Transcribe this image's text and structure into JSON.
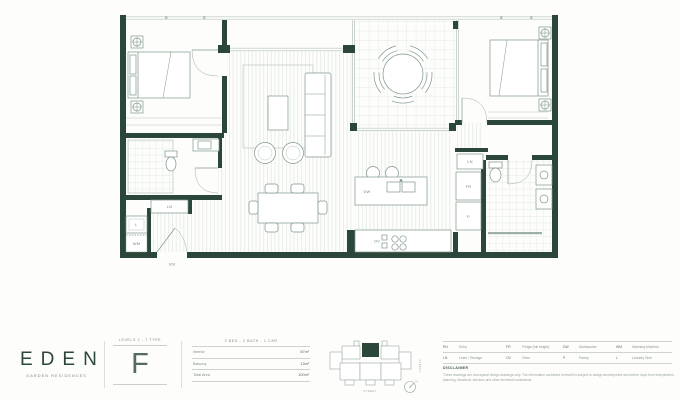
{
  "brand": {
    "name": "EDEN",
    "tagline": "GARDEN RESIDENCES"
  },
  "unit": {
    "levels_label": "LEVELS 2 - 7 TYPE",
    "type": "F",
    "config": "2 BED - 2 BATH - 1 CAR",
    "areas": [
      {
        "label": "Interior",
        "value": "87m²"
      },
      {
        "label": "Balcony",
        "value": "13m²"
      },
      {
        "label": "Total Area",
        "value": "100m²"
      }
    ]
  },
  "legend": {
    "rows": [
      [
        {
          "abbr": "EN",
          "label": "Entry"
        },
        {
          "abbr": "FR",
          "label": "Fridge (full height)"
        },
        {
          "abbr": "DW",
          "label": "Dishwasher"
        },
        {
          "abbr": "WM",
          "label": "Washing Machine"
        }
      ],
      [
        {
          "abbr": "LN",
          "label": "Linen / Storage"
        },
        {
          "abbr": "OV",
          "label": "Oven"
        },
        {
          "abbr": "P",
          "label": "Pantry"
        },
        {
          "abbr": "L",
          "label": "Laundry Sink"
        }
      ]
    ]
  },
  "disclaimer": {
    "title": "DISCLAIMER",
    "body": "These drawings are conceptual design drawings only. The information contained herewith is subject to design development and further input from independent planning, structural, services and other technical consultants."
  },
  "plan": {
    "labels": {
      "entry": "EN",
      "linen_left": "LN",
      "laundry_sink": "L",
      "washing_machine": "WM",
      "dishwasher": "DW",
      "oven": "OV",
      "linen_right": "LN",
      "fridge": "FR",
      "pantry": "P"
    }
  },
  "key_plan": {
    "street_right": "STREET",
    "street_bottom": "STREET",
    "north": "N"
  },
  "colors": {
    "wall": "#2b4739",
    "line": "#7f978b",
    "accent": "#2b4739"
  }
}
